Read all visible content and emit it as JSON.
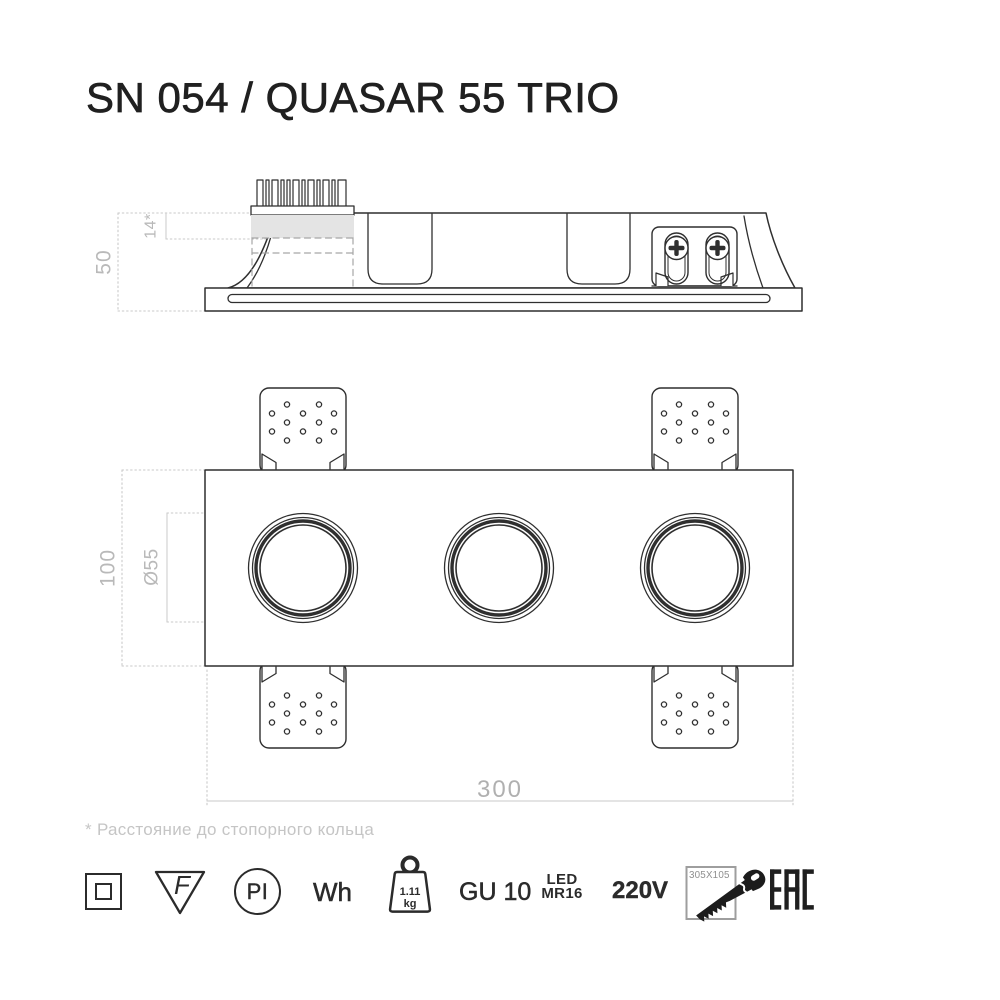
{
  "title": "SN 054 / QUASAR 55 TRIO",
  "footnote": "* Расстояние до стопорного кольца",
  "colors": {
    "line": "#2f2f2f",
    "dim_text": "#b9b9b9",
    "dim_line": "#cccccc",
    "hidden_fill": "#e4e4e4",
    "icon_dark": "#2b2b2b",
    "saw_box_gray": "#9e9e9e"
  },
  "drawing": {
    "side_view": {
      "height": "50",
      "protrusion": "14*"
    },
    "front_view": {
      "height": "100",
      "hole_diameter": "Ø55",
      "width": "300"
    }
  },
  "icons": {
    "class2": {
      "name": "class-ii-double-insulation"
    },
    "f_mark": {
      "label": "F"
    },
    "plaster": {
      "label": "PI"
    },
    "color": {
      "label": "Wh"
    },
    "weight": {
      "value": "1.11",
      "unit": "kg"
    },
    "socket": {
      "label": "GU 10"
    },
    "lamp": {
      "line1": "LED",
      "line2": "MR16"
    },
    "voltage": {
      "label": "220V"
    },
    "cutout": {
      "label": "305X105"
    },
    "certification": {
      "label": "EAC"
    }
  }
}
